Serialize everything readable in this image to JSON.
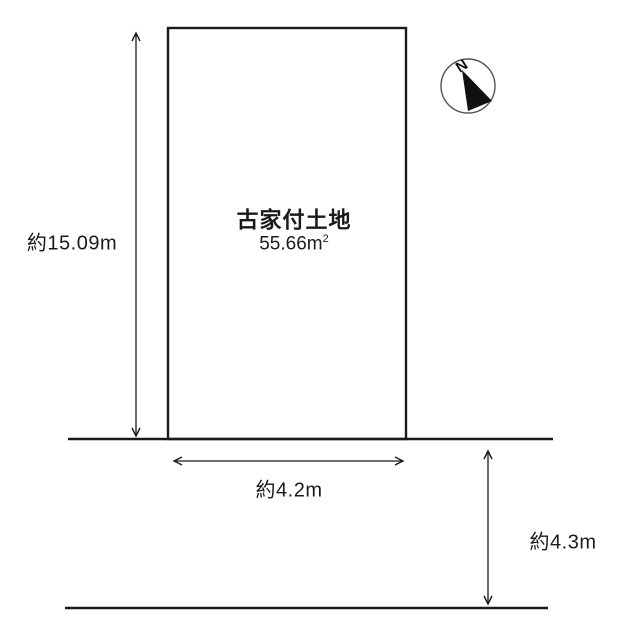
{
  "plot": {
    "title": "古家付土地",
    "area_value": "55.66m",
    "area_exponent": "2"
  },
  "dimensions": {
    "depth_label": "約15.09m",
    "frontage_label": "約4.2m",
    "road_width_label": "約4.3m"
  },
  "compass": {
    "north_label": "N"
  },
  "colors": {
    "line": "#1a1a1a",
    "background": "#ffffff"
  }
}
